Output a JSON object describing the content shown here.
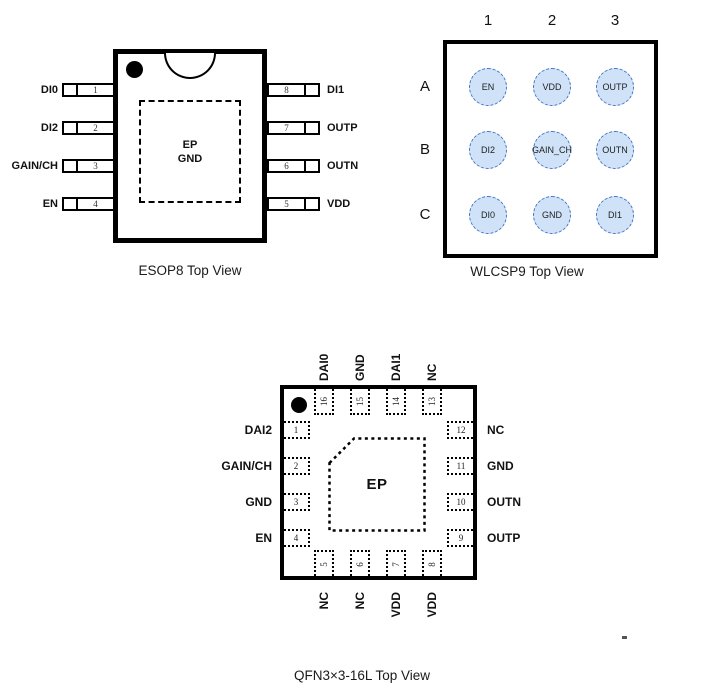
{
  "esop8": {
    "caption": "ESOP8 Top View",
    "ep_line1": "EP",
    "ep_line2": "GND",
    "left_pins": [
      {
        "num": "1",
        "label": "DI0"
      },
      {
        "num": "2",
        "label": "DI2"
      },
      {
        "num": "3",
        "label": "GAIN/CH"
      },
      {
        "num": "4",
        "label": "EN"
      }
    ],
    "right_pins": [
      {
        "num": "8",
        "label": "DI1"
      },
      {
        "num": "7",
        "label": "OUTP"
      },
      {
        "num": "6",
        "label": "OUTN"
      },
      {
        "num": "5",
        "label": "VDD"
      }
    ]
  },
  "wlcsp9": {
    "caption": "WLCSP9 Top View",
    "col_headers": [
      "1",
      "2",
      "3"
    ],
    "row_headers": [
      "A",
      "B",
      "C"
    ],
    "balls": [
      [
        "EN",
        "VDD",
        "OUTP"
      ],
      [
        "DI2",
        "GAIN_CH",
        "OUTN"
      ],
      [
        "DI0",
        "GND",
        "DI1"
      ]
    ],
    "ball_fill": "#cfe2f8",
    "ball_border": "#4472c4"
  },
  "qfn16": {
    "caption": "QFN3×3-16L Top View",
    "ep_label": "EP",
    "top_pins": [
      {
        "num": "16",
        "label": "DAI0"
      },
      {
        "num": "15",
        "label": "GND"
      },
      {
        "num": "14",
        "label": "DAI1"
      },
      {
        "num": "13",
        "label": "NC"
      }
    ],
    "left_pins": [
      {
        "num": "1",
        "label": "DAI2"
      },
      {
        "num": "2",
        "label": "GAIN/CH"
      },
      {
        "num": "3",
        "label": "GND"
      },
      {
        "num": "4",
        "label": "EN"
      }
    ],
    "right_pins": [
      {
        "num": "12",
        "label": "NC"
      },
      {
        "num": "11",
        "label": "GND"
      },
      {
        "num": "10",
        "label": "OUTN"
      },
      {
        "num": "9",
        "label": "OUTP"
      }
    ],
    "bottom_pins": [
      {
        "num": "5",
        "label": "NC"
      },
      {
        "num": "6",
        "label": "NC"
      },
      {
        "num": "7",
        "label": "VDD"
      },
      {
        "num": "8",
        "label": "VDD"
      }
    ]
  }
}
